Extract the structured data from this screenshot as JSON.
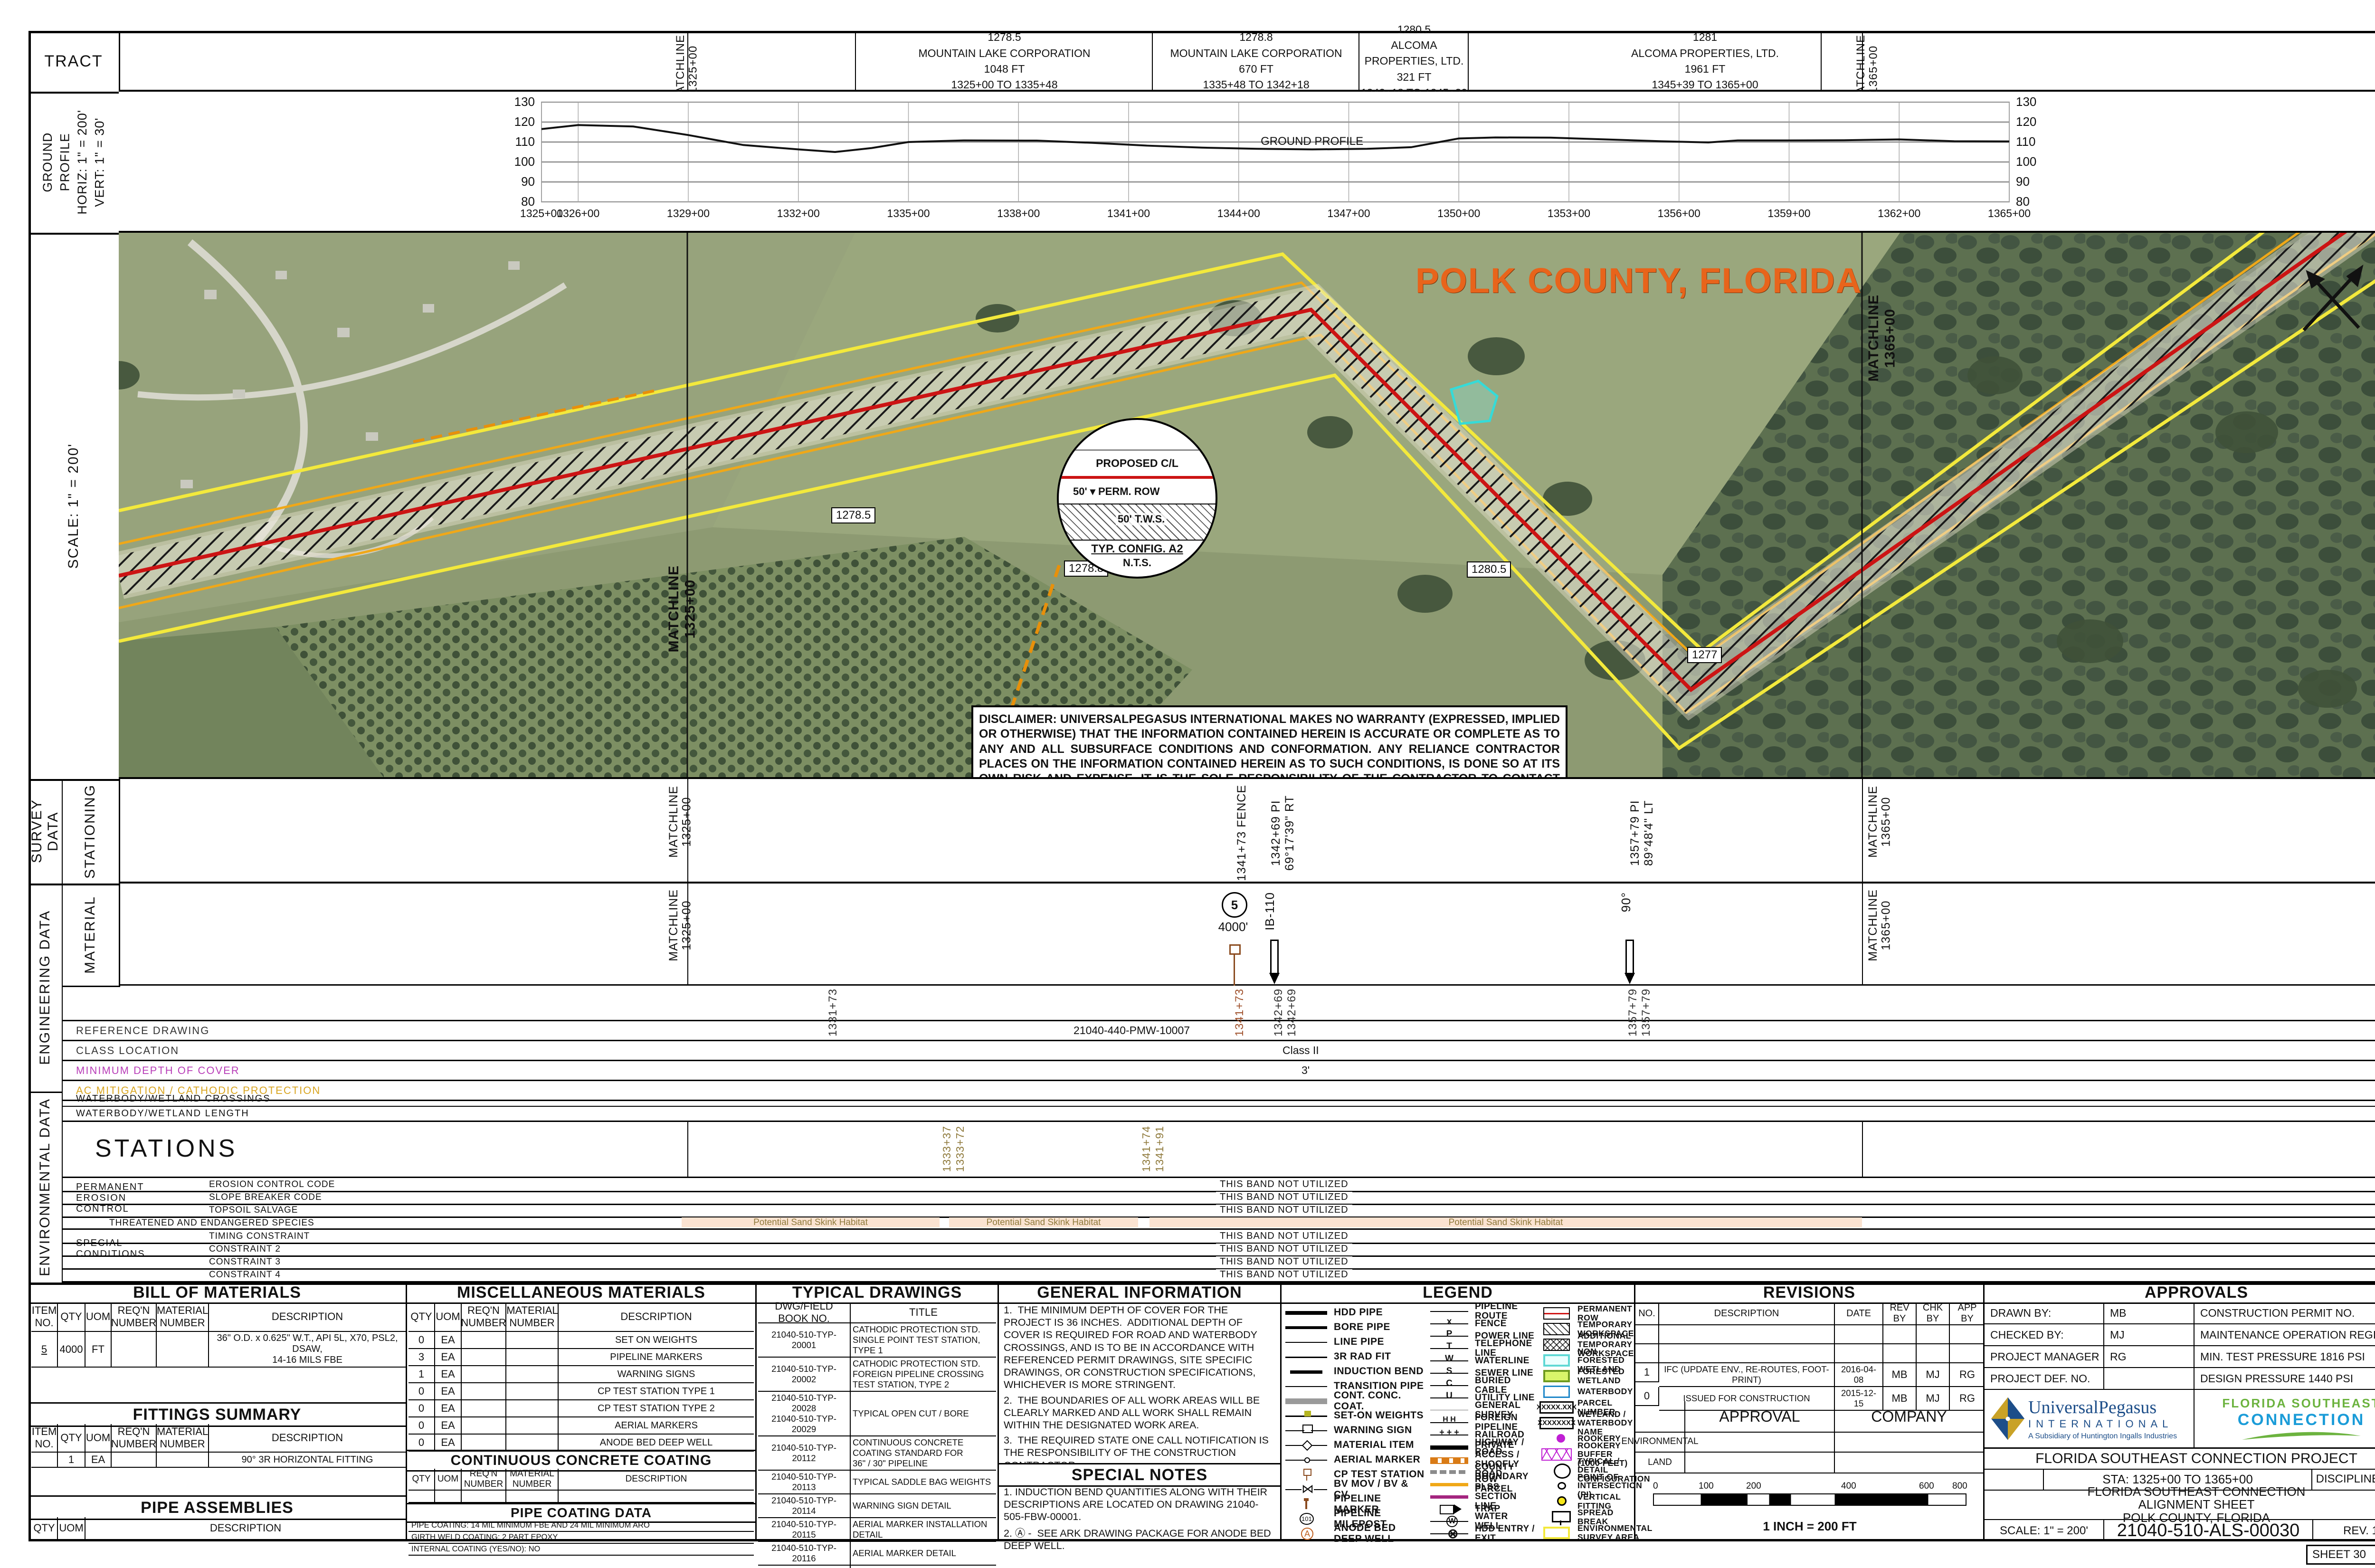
{
  "colors": {
    "route_red": "#cc1414",
    "row_orange": "#f0a818",
    "survey_yellow": "#f3e93c",
    "polk_orange": "#e8641b",
    "habitat_pink": "#fbe3d1",
    "habitat_text": "#8f7a3c",
    "min_depth_label": "#b83db8",
    "ac_mitigation_label": "#d9a520"
  },
  "tract": {
    "label": "TRACT",
    "matchline_left": "MATCHLINE\n1325+00",
    "matchline_right": "MATCHLINE\n1365+00",
    "cells": [
      {
        "x1": 1550,
        "x2": 2175,
        "tract_no": "1278.5",
        "owner": "MOUNTAIN LAKE CORPORATION",
        "length": "1048 FT",
        "stations": "1325+00 TO 1335+48"
      },
      {
        "x1": 2175,
        "x2": 2610,
        "tract_no": "1278.8",
        "owner": "MOUNTAIN LAKE CORPORATION",
        "length": "670 FT",
        "stations": "1335+48 TO 1342+18"
      },
      {
        "x1": 2610,
        "x2": 2840,
        "tract_no": "1280.5",
        "owner": "ALCOMA PROPERTIES, LTD.",
        "length": "321 FT",
        "stations": "1342+18 TO 1345+39"
      },
      {
        "x1": 2840,
        "x2": 3835,
        "tract_no": "1281",
        "owner": "ALCOMA PROPERTIES, LTD.",
        "length": "1961 FT",
        "stations": "1345+39 TO 1365+00"
      }
    ]
  },
  "profile": {
    "label": "GROUND\nPROFILE\nHORIZ: 1\" = 200'\nVERT: 1\" = 30'"
  },
  "chart_data": {
    "type": "line",
    "title": "",
    "xlabel": "stations",
    "ylabel": "elevation (ft)",
    "ylim": [
      80,
      130
    ],
    "yticks": [
      80,
      90,
      100,
      110,
      120,
      130
    ],
    "xtick_values": [
      1325,
      1326,
      1329,
      1332,
      1335,
      1338,
      1341,
      1344,
      1347,
      1350,
      1353,
      1356,
      1359,
      1362,
      1365
    ],
    "xtick_labels": [
      "1325+00",
      "1326+00",
      "1329+00",
      "1332+00",
      "1335+00",
      "1338+00",
      "1341+00",
      "1344+00",
      "1347+00",
      "1350+00",
      "1353+00",
      "1356+00",
      "1359+00",
      "1362+00",
      "1365+00"
    ],
    "annotation": "GROUND PROFILE",
    "annotation_xy": [
      1344.6,
      108.6
    ],
    "grid": true,
    "series": [
      {
        "name": "ground profile",
        "points": [
          [
            1325,
            116.5
          ],
          [
            1326,
            118.5
          ],
          [
            1327.5,
            117.8
          ],
          [
            1329,
            113.5
          ],
          [
            1330.5,
            108.5
          ],
          [
            1332,
            106.3
          ],
          [
            1333,
            105.0
          ],
          [
            1334,
            107.0
          ],
          [
            1335,
            110.0
          ],
          [
            1336.5,
            110.8
          ],
          [
            1338.5,
            110.7
          ],
          [
            1340,
            109.6
          ],
          [
            1341.5,
            108.2
          ],
          [
            1343,
            107.2
          ],
          [
            1344.5,
            106.6
          ],
          [
            1346,
            106.3
          ],
          [
            1347.5,
            106.6
          ],
          [
            1348.7,
            107.4
          ],
          [
            1350,
            111.8
          ],
          [
            1351,
            112.3
          ],
          [
            1352.5,
            112.2
          ],
          [
            1354,
            111.3
          ],
          [
            1355.5,
            110.4
          ],
          [
            1356.8,
            109.8
          ],
          [
            1357.6,
            110.8
          ],
          [
            1359,
            110.8
          ],
          [
            1360.5,
            110.9
          ],
          [
            1362,
            111.3
          ],
          [
            1363.5,
            110.4
          ],
          [
            1365,
            110.3
          ]
        ]
      }
    ]
  },
  "map": {
    "scale_label": "SCALE: 1\" = 200'",
    "title": "POLK COUNTY, FLORIDA",
    "matchline_left": "MATCHLINE\n1325+00",
    "matchline_right": "MATCHLINE\n1365+00",
    "parcels": [
      {
        "x": 1500,
        "y": 578,
        "text": "1278.5"
      },
      {
        "x": 1990,
        "y": 690,
        "text": "1278.8"
      },
      {
        "x": 2838,
        "y": 692,
        "text": "1280.5"
      },
      {
        "x": 2632,
        "y": 998,
        "text": "1277.5"
      },
      {
        "x": 3302,
        "y": 872,
        "text": "1277"
      }
    ],
    "detail": {
      "cl": "PROPOSED C/L",
      "dim1": "50'",
      "row": "PERM. ROW",
      "dim2": "50'",
      "tws": "T.W.S.",
      "title": "TYP. CONFIG. A2",
      "sub": "N.T.S."
    },
    "disclaimer": "DISCLAIMER: UNIVERSALPEGASUS INTERNATIONAL MAKES NO WARRANTY (EXPRESSED, IMPLIED OR OTHERWISE) THAT THE INFORMATION CONTAINED HEREIN IS ACCURATE OR COMPLETE AS TO ANY AND ALL SUBSURFACE CONDITIONS AND CONFORMATION.  ANY RELIANCE CONTRACTOR PLACES ON THE INFORMATION CONTAINED HEREIN AS TO SUCH CONDITIONS, IS DONE SO AT ITS OWN RISK AND EXPENSE.  IT IS THE SOLE RESPONSIBILITY OF THE CONTRACTOR TO CONTACT THE STATE \"ONE CALL\" SYSTEM PRIOR TO ANY EXCAVATION."
  },
  "survey": {
    "outer_label": "SURVEY DATA",
    "inner_label": "STATIONING",
    "matchline_left": "MATCHLINE\n1325+00",
    "matchline_right": "MATCHLINE\n1365+00",
    "stations": [
      {
        "x": 2600,
        "text": "1341+73 FENCE"
      },
      {
        "x": 2672,
        "text": "1342+69  PI  69°17'39\" RT",
        "underline": true
      },
      {
        "x": 3428,
        "text": "1357+79  PI  89°48'4\" LT",
        "underline": true
      }
    ]
  },
  "engineering": {
    "outer_label": "ENGINEERING DATA",
    "inner_label": "MATERIAL",
    "matchline_left": "MATCHLINE\n1325+00",
    "matchline_right": "MATCHLINE\n1365+00",
    "item_circle": "5",
    "item_qty": "4000'",
    "item_ib": "IB-110",
    "item_angle": "90°",
    "strip_stations": [
      {
        "x": 1740,
        "text": "1331+73",
        "color": "#333333"
      },
      {
        "x": 2596,
        "text": "1341+73",
        "color": "#a0522d"
      },
      {
        "x": 2678,
        "text": "1342+69",
        "color": "#333333"
      },
      {
        "x": 2706,
        "text": "1342+69",
        "color": "#333333"
      },
      {
        "x": 3424,
        "text": "1357+79",
        "color": "#333333"
      },
      {
        "x": 3452,
        "text": "1357+79",
        "color": "#333333"
      }
    ],
    "rows": [
      {
        "label": "REFERENCE DRAWING",
        "value": "21040-440-PMW-10007",
        "label_color": "#333333",
        "vx": 2260
      },
      {
        "label": "CLASS LOCATION",
        "value": "Class II",
        "label_color": "#333333",
        "vx": 2700
      },
      {
        "label": "MINIMUM DEPTH OF COVER",
        "value": "3'",
        "label_color": "#b83db8",
        "vx": 2740
      },
      {
        "label": "AC MITIGATION / CATHODIC PROTECTION",
        "value": "",
        "label_color": "#d9a520",
        "vx": 2700
      }
    ]
  },
  "environmental": {
    "outer_label": "ENVIRONMENTAL DATA",
    "row_crossings": "WATERBODY/WETLAND CROSSINGS",
    "row_length": "WATERBODY/WETLAND LENGTH",
    "stations_label": "STATIONS",
    "matchline_left": "MATCHLINE 1325+00",
    "matchline_right": "MATCHLINE 1365+00",
    "env_stations": [
      {
        "x": 1980,
        "text": "1333+37"
      },
      {
        "x": 2008,
        "text": "1333+72"
      },
      {
        "x": 2400,
        "text": "1341+74"
      },
      {
        "x": 2428,
        "text": "1341+91"
      }
    ],
    "group1": "PERMANENT\n EROSION\nCONTROL",
    "group2": "SPECIAL\nCONDITIONS",
    "not_utilized": "THIS BAND NOT UTILIZED",
    "band_rows_top": [
      {
        "y": 2480,
        "label": "EROSION CONTROL CODE"
      },
      {
        "y": 2507,
        "label": "SLOPE BREAKER CODE"
      },
      {
        "y": 2534,
        "label": "TOPSOIL SALVAGE"
      }
    ],
    "te_label": "THREATENED AND ENDANGERED SPECIES",
    "habitat_segments": [
      {
        "x1": 1435,
        "x2": 1978,
        "text": "Potential Sand Skink Habitat"
      },
      {
        "x1": 1998,
        "x2": 2396,
        "text": "Potential Sand Skink Habitat"
      },
      {
        "x1": 2420,
        "x2": 3920,
        "text": "Potential Sand Skink Habitat"
      }
    ],
    "band_rows_bottom": [
      {
        "y": 2589,
        "label": "TIMING CONSTRAINT"
      },
      {
        "y": 2616,
        "label": "CONSTRAINT 2"
      },
      {
        "y": 2643,
        "label": "CONSTRAINT 3"
      },
      {
        "y": 2670,
        "label": "CONSTRAINT 4"
      }
    ]
  },
  "bom": {
    "title": "BILL OF MATERIALS",
    "headers": [
      "ITEM\nNO.",
      "QTY",
      "UOM",
      "REQ'N\nNUMBER",
      "MATERIAL\nNUMBER",
      "DESCRIPTION"
    ],
    "rows": [
      [
        "5",
        "4000",
        "FT",
        "",
        "",
        "36\" O.D. x 0.625\" W.T., API 5L, X70, PSL2, DSAW,\n14-16 MILS FBE"
      ]
    ],
    "fittings_title": "FITTINGS SUMMARY",
    "fittings_rows": [
      [
        "",
        "1",
        "EA",
        "",
        "",
        "90° 3R HORIZONTAL FITTING"
      ]
    ],
    "assemblies_title": "PIPE ASSEMBLIES",
    "assemblies_headers": [
      "QTY",
      "UOM",
      "DESCRIPTION"
    ]
  },
  "misc": {
    "title": "MISCELLANEOUS MATERIALS",
    "headers": [
      "QTY",
      "UOM",
      "REQ'N\nNUMBER",
      "MATERIAL NUMBER",
      "DESCRIPTION"
    ],
    "rows": [
      [
        "0",
        "EA",
        "",
        "",
        "SET ON WEIGHTS"
      ],
      [
        "3",
        "EA",
        "",
        "",
        "PIPELINE MARKERS"
      ],
      [
        "1",
        "EA",
        "",
        "",
        "WARNING SIGNS"
      ],
      [
        "0",
        "EA",
        "",
        "",
        "CP TEST STATION TYPE 1"
      ],
      [
        "0",
        "EA",
        "",
        "",
        "CP TEST STATION TYPE 2"
      ],
      [
        "0",
        "EA",
        "",
        "",
        "AERIAL MARKERS"
      ],
      [
        "0",
        "EA",
        "",
        "",
        "ANODE BED DEEP WELL"
      ]
    ],
    "ccc_title": "CONTINUOUS CONCRETE COATING",
    "ccc_rows": [
      [
        "",
        "",
        "",
        "",
        ""
      ]
    ],
    "coating_title": "PIPE COATING DATA",
    "coating_lines": [
      "PIPE COATING: 14 MIL MINIMUM FBE AND 24 MIL MINIMUM ARO",
      "GIRTH WELD COATING: 2 PART EPOXY",
      "INTERNAL COATING (YES/NO): NO"
    ]
  },
  "typical": {
    "title": "TYPICAL DRAWINGS",
    "headers": [
      "DWG/FIELD BOOK NO.",
      "TITLE"
    ],
    "rows": [
      [
        "21040-510-TYP-20001",
        "CATHODIC PROTECTION STD.\nSINGLE POINT TEST STATION,\nTYPE 1"
      ],
      [
        "21040-510-TYP-20002",
        "CATHODIC PROTECTION STD.\nFOREIGN PIPELINE CROSSING\nTEST STATION, TYPE 2"
      ],
      [
        "21040-510-TYP-20028\n21040-510-TYP-20029",
        "TYPICAL OPEN CUT / BORE"
      ],
      [
        "21040-510-TYP-20112",
        "CONTINUOUS CONCRETE\nCOATING STANDARD FOR\n36\" / 30\" PIPELINE"
      ],
      [
        "21040-510-TYP-20113",
        "TYPICAL SADDLE BAG WEIGHTS"
      ],
      [
        "21040-510-TYP-20114",
        "WARNING SIGN DETAIL"
      ],
      [
        "21040-510-TYP-20115",
        "AERIAL MARKER INSTALLATION\nDETAIL"
      ],
      [
        "21040-510-TYP-20116",
        "AERIAL MARKER DETAIL"
      ],
      [
        "21040-510-TYP-20117",
        "TYPICAL PIPELINE MARKER\nASSEMBLY"
      ],
      [
        "21040-510-TYP-20118",
        "PIPELINE MARKER \"WARNING\"\nDECAL"
      ]
    ]
  },
  "general_info": {
    "title": "GENERAL INFORMATION",
    "items": [
      "1.  THE MINIMUM DEPTH OF COVER FOR THE PROJECT IS 36 INCHES.  ADDITIONAL DEPTH OF COVER IS REQUIRED FOR ROAD AND WATERBODY CROSSINGS, AND IS TO BE IN ACCORDANCE WITH REFERENCED PERMIT DRAWINGS, SITE SPECIFIC DRAWINGS, OR CONSTRUCTION SPECIFICATIONS, WHICHEVER IS MORE STRINGENT.",
      "2.  THE BOUNDARIES OF ALL WORK AREAS WILL BE CLEARLY MARKED AND ALL WORK SHALL REMAIN WITHIN THE DESIGNATED WORK AREA.",
      "3.  THE REQUIRED STATE ONE CALL NOTIFICATION IS THE RESPONSIBILITY OF THE CONSTRUCTION CONTRACTOR.",
      "4.  THE CONTRACTOR SHALL ACCESS THE WORK AREA USING ONLY PUBLIC ROADS AND APPROVED ACCESS ROADS.",
      "5.  ADDITIONAL WARNING SIGNS MAY BE REQUIRED AS DICTATED BY CONSTRUCTION CONTRACT.",
      "6.  MAP PROJECTION: NAD 1983 HARN STATE PLANE FLORIDA EAST FIPS 0901 FEET.  VERTICAL DATUM: NAVD 88."
    ],
    "special_title": "SPECIAL NOTES",
    "special_items": [
      "1. INDUCTION BEND QUANTITIES ALONG WITH THEIR DESCRIPTIONS ARE LOCATED ON DRAWING 21040-505-FBW-00001.",
      "2. Ⓐ -  SEE ARK DRAWING PACKAGE FOR ANODE BED DEEP WELL."
    ]
  },
  "legend": {
    "title": "LEGEND",
    "colA": [
      {
        "sym": "hdd",
        "label": "HDD PIPE"
      },
      {
        "sym": "bore",
        "label": "BORE PIPE"
      },
      {
        "sym": "line-pipe",
        "label": "LINE PIPE"
      },
      {
        "sym": "rad-fit",
        "label": "3R RAD FIT"
      },
      {
        "sym": "induction",
        "label": "INDUCTION BEND"
      },
      {
        "sym": "transition",
        "label": "TRANSITION PIPE"
      },
      {
        "sym": "conc",
        "label": "CONT. CONC. COAT."
      },
      {
        "sym": "set-on",
        "label": "SET-ON WEIGHTS"
      },
      {
        "sym": "warning",
        "label": "WARNING SIGN"
      },
      {
        "sym": "material",
        "label": "MATERIAL ITEM"
      },
      {
        "sym": "aerial",
        "label": "AERIAL MARKER"
      },
      {
        "sym": "cpts",
        "label": "CP TEST STATION"
      },
      {
        "sym": "bv",
        "label": "BV MOV / BV & CV"
      },
      {
        "sym": "pmarker",
        "label": "PIPELINE MARKER"
      },
      {
        "sym": "milepost",
        "label": "PIPELINE MILEPOST"
      },
      {
        "sym": "anode",
        "label": "ANODE BED DEEP WELL"
      }
    ],
    "colB": [
      {
        "sym": "route",
        "label": "PIPELINE ROUTE"
      },
      {
        "sym": "fence",
        "label": "FENCE",
        "line": true
      },
      {
        "sym": "power",
        "label": "POWER LINE",
        "line": true
      },
      {
        "sym": "telephone",
        "label": "TELEPHONE LINE",
        "line": true
      },
      {
        "sym": "water",
        "label": "WATERLINE",
        "line": true
      },
      {
        "sym": "sewer",
        "label": "SEWER LINE",
        "line": true
      },
      {
        "sym": "cable",
        "label": "BURIED CABLE",
        "line": true
      },
      {
        "sym": "utility",
        "label": "UTILITY LINE",
        "line": true
      },
      {
        "sym": "survey",
        "label": "GENERAL SURVEY"
      },
      {
        "sym": "foreign",
        "label": "FOREIGN PIPELINE"
      },
      {
        "sym": "railroad",
        "label": "RAILROAD"
      },
      {
        "sym": "highway",
        "label": "HIGHWAY / ROAD"
      },
      {
        "sym": "private",
        "label": "PRIVATE ACCESS /\nSHOOFLY ROAD"
      },
      {
        "sym": "county",
        "label": "COUNTY BOUNDARY"
      },
      {
        "sym": "rowparcel",
        "label": "ROW PARCEL"
      },
      {
        "sym": "plss",
        "label": "PLSS SECTION LINE"
      },
      {
        "sym": "trap",
        "label": "TRAP"
      },
      {
        "sym": "waterwell",
        "label": "WATER WELL"
      },
      {
        "sym": "hddentry",
        "label": "HDD ENTRY / EXIT"
      }
    ],
    "colC": [
      {
        "sym": "permrow",
        "label": "PERMANENT ROW"
      },
      {
        "sym": "tws",
        "label": "TEMPORARY WORKSPACE"
      },
      {
        "sym": "atws",
        "label": "ADDITIONAL TEMPORARY\nWORKSPACE"
      },
      {
        "sym": "nfw",
        "label": "NON FORESTED WETLAND"
      },
      {
        "sym": "fw",
        "label": "FORESTED WETLAND"
      },
      {
        "sym": "wb",
        "label": "WATERBODY"
      },
      {
        "sym": "parcel",
        "label": "PARCEL NUMBER"
      },
      {
        "sym": "wbname",
        "label": "WETLAND / WATERBODY\nNAME"
      },
      {
        "sym": "rookery",
        "label": "ROOKERY"
      },
      {
        "sym": "rookerybuf",
        "label": "ROOKERY BUFFER\n(1000 FEET)"
      },
      {
        "sym": "typdetail",
        "label": "TYPICAL / DETAIL\nCONFIGURATION"
      },
      {
        "sym": "pi",
        "label": "POINT OF\nINTERSECTION (PI)"
      },
      {
        "sym": "vfit",
        "label": "VERTICAL FITTING"
      },
      {
        "sym": "spread",
        "label": "SPREAD BREAK"
      },
      {
        "sym": "esa",
        "label": "ENVIRONMENTAL\nSURVEY AREA"
      }
    ]
  },
  "revisions": {
    "title": "REVISIONS",
    "headers": [
      "NO.",
      "DESCRIPTION",
      "DATE",
      "REV\nBY",
      "CHK\nBY",
      "APP\nBY"
    ],
    "rows": [
      [
        "",
        "",
        "",
        "",
        "",
        ""
      ],
      [
        "",
        "",
        "",
        "",
        "",
        ""
      ],
      [
        "1",
        "IFC (UPDATE ENV., RE-ROUTES, FOOT-PRINT)",
        "2016-04-08",
        "MB",
        "MJ",
        "RG"
      ],
      [
        "0",
        "ISSUED FOR CONSTRUCTION",
        "2015-12-15",
        "MB",
        "MJ",
        "RG"
      ]
    ],
    "approval_header": "APPROVAL",
    "company_header": "COMPANY",
    "approval_rows": [
      "ENVIRONMENTAL",
      "LAND"
    ],
    "scalebar": {
      "ticks": [
        "0",
        "100",
        "200",
        "400",
        "600",
        "800"
      ],
      "caption": "1 INCH = 200 FT"
    }
  },
  "approvals": {
    "title": "APPROVALS",
    "left_rows": [
      {
        "label": "DRAWN BY:",
        "value": "MB"
      },
      {
        "label": "CHECKED BY:",
        "value": "MJ"
      },
      {
        "label": "PROJECT MANAGER",
        "value": "RG"
      },
      {
        "label": "PROJECT DEF. NO.",
        "value": ""
      }
    ],
    "right_rows": [
      "CONSTRUCTION      PERMIT      NO.",
      "MAINTENANCE OPERATION REGION",
      "MIN. TEST PRESSURE      1816      PSI",
      "DESIGN PRESSURE      1440      PSI"
    ],
    "up_logo": {
      "line1": "UniversalPegasus",
      "line2": "INTERNATIONAL",
      "line3": "A Subsidiary of Huntington Ingalls Industries"
    },
    "fsc_logo": {
      "line1": "FLORIDA  SOUTHEAST",
      "line2": "CONNECTION"
    },
    "project": "FLORIDA SOUTHEAST CONNECTION PROJECT",
    "sta": "STA:    1325+00    TO    1365+00",
    "discipline": "DISCIPLINE#: 03",
    "title_lines": [
      "FLORIDA SOUTHEAST CONNECTION",
      "ALIGNMENT SHEET",
      "POLK COUNTY, FLORIDA"
    ],
    "scale": "SCALE: 1\" = 200'",
    "dwg_no": "21040-510-ALS-00030",
    "rev": "REV.   1",
    "sheet": "SHEET 30"
  }
}
